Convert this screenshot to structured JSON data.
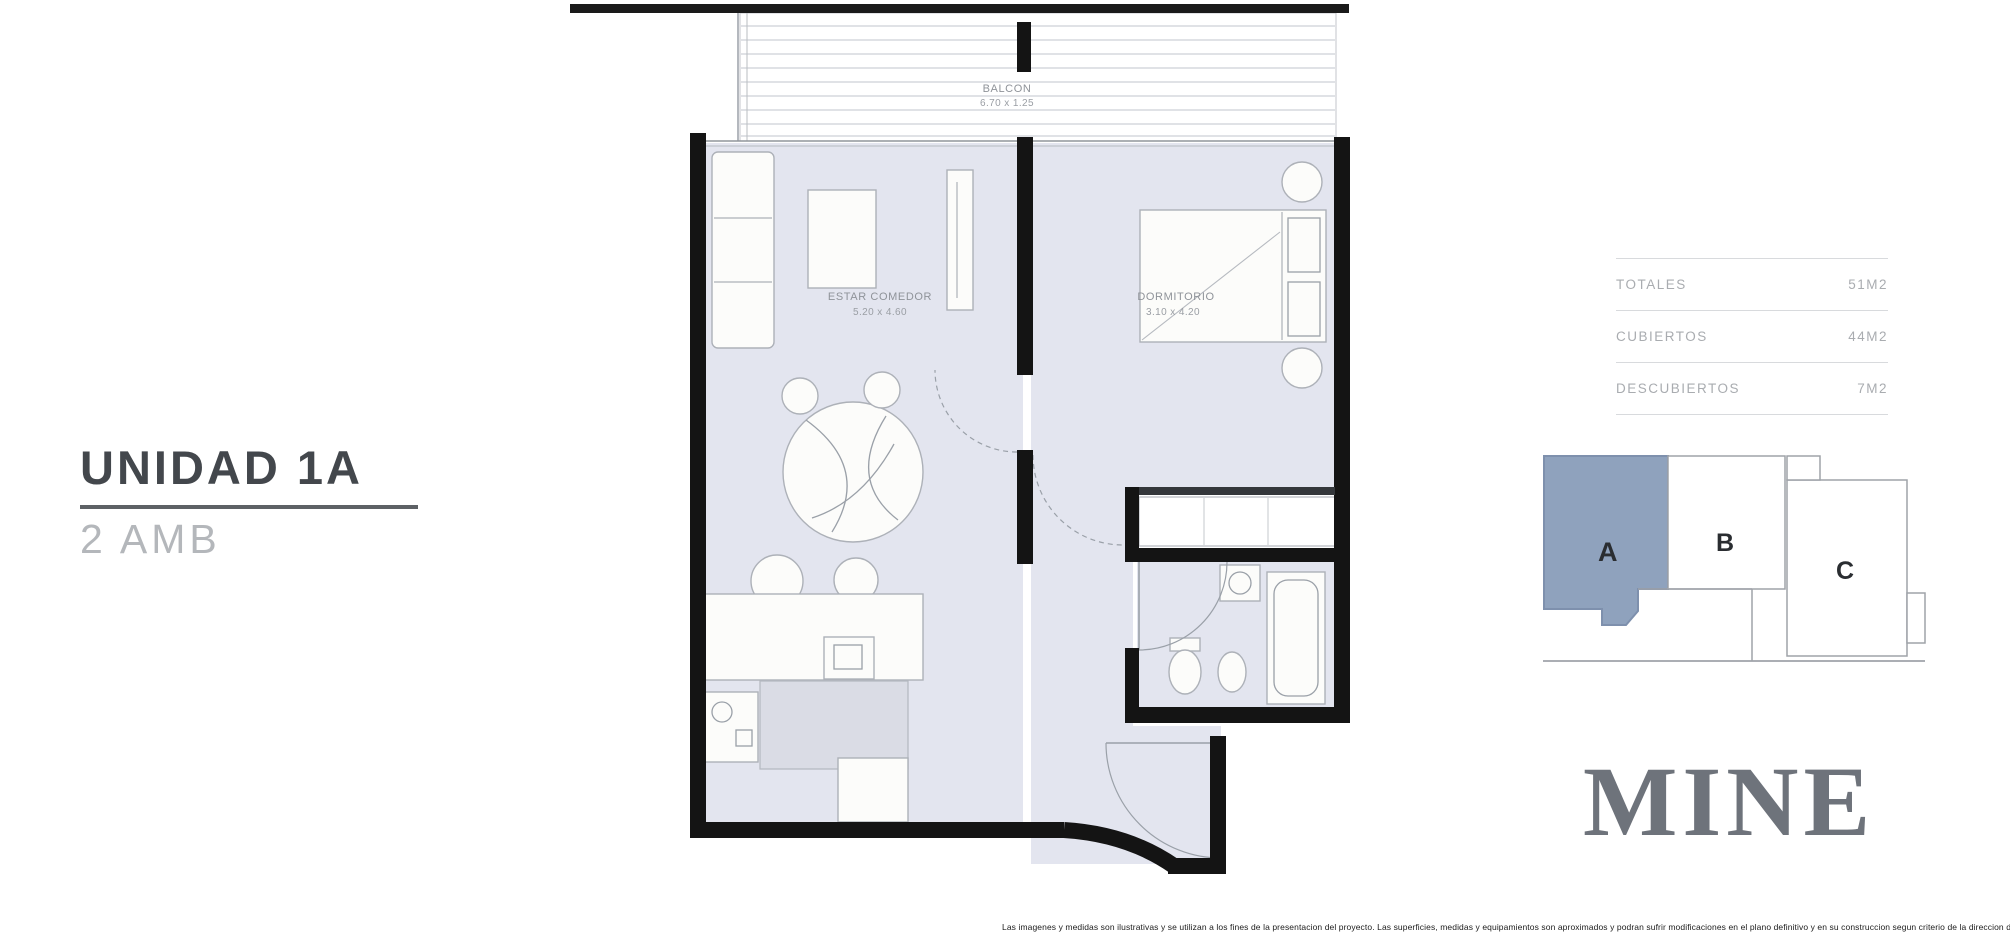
{
  "header": {
    "unit_title": "UNIDAD 1A",
    "unit_subtitle": "2 AMB"
  },
  "floor_plan": {
    "rooms": {
      "balcony": {
        "name": "BALCON",
        "dims": "6.70 x 1.25"
      },
      "living": {
        "name": "ESTAR COMEDOR",
        "dims": "5.20 x 4.60"
      },
      "bedroom": {
        "name": "DORMITORIO",
        "dims": "3.10 x 4.20"
      }
    }
  },
  "areas_table": {
    "rows": [
      {
        "label": "TOTALES",
        "value": "51M2"
      },
      {
        "label": "CUBIERTOS",
        "value": "44M2"
      },
      {
        "label": "DESCUBIERTOS",
        "value": "7M2"
      }
    ]
  },
  "unit_key": {
    "units": [
      "A",
      "B",
      "C"
    ],
    "highlighted_unit": "A",
    "highlight_color": "#8fa2bd"
  },
  "brand": {
    "logo_text": "MINE"
  },
  "fine_print": {
    "text": "Las imagenes y medidas son ilustrativas y se utilizan a los fines de la presentacion del proyecto. Las superficies, medidas y equipamientos son aproximados y podran sufrir modificaciones en el plano definitivo y en su construccion segun criterio de la direccion de obra."
  },
  "colors": {
    "wall": "#141414",
    "floor": "#e3e5ef",
    "accent_unit": "#8fa2bd"
  }
}
